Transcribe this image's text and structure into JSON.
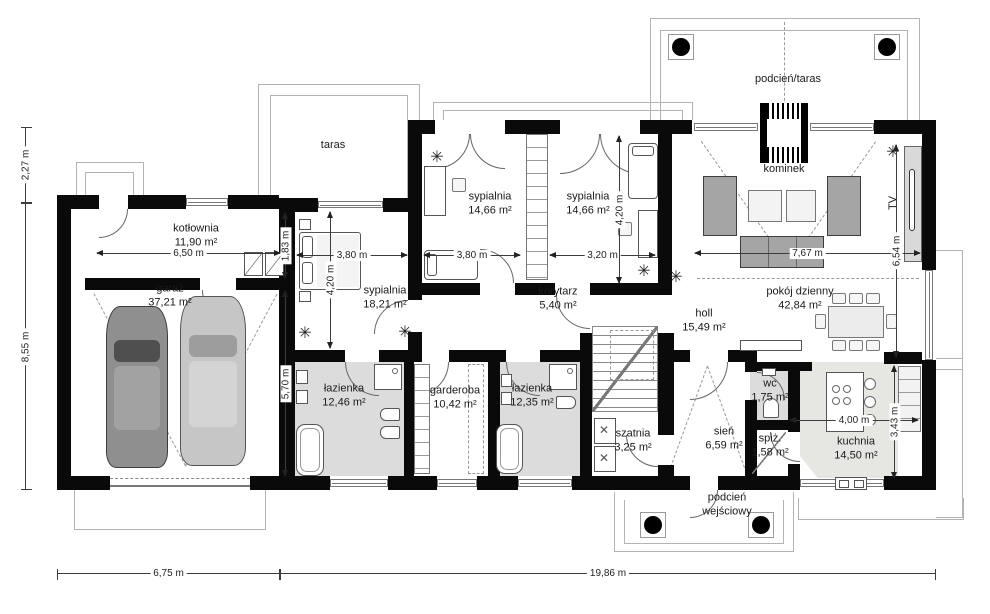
{
  "rooms": {
    "kotlownia": {
      "name": "kotłownia",
      "area": "11,90 m²"
    },
    "garaz": {
      "name": "garaż",
      "area": "37,21 m²"
    },
    "syp1": {
      "name": "sypialnia",
      "area": "18,21 m²"
    },
    "syp2": {
      "name": "sypialnia",
      "area": "14,66 m²"
    },
    "syp3": {
      "name": "sypialnia",
      "area": "14,66 m²"
    },
    "korytarz": {
      "name": "korytarz",
      "area": "5,40 m²"
    },
    "laz1": {
      "name": "łazienka",
      "area": "12,46 m²"
    },
    "garderoba": {
      "name": "garderoba",
      "area": "10,42 m²"
    },
    "laz2": {
      "name": "łazienka",
      "area": "12,35 m²"
    },
    "szatnia": {
      "name": "szatnia",
      "area": "3,25 m²"
    },
    "sien": {
      "name": "sień",
      "area": "6,59 m²"
    },
    "wc": {
      "name": "wc",
      "area": "1,75 m²"
    },
    "spiz": {
      "name": "spiż.",
      "area": "1,58 m²"
    },
    "kuchnia": {
      "name": "kuchnia",
      "area": "14,50 m²"
    },
    "holl": {
      "name": "holl",
      "area": "15,49 m²"
    },
    "pokoj": {
      "name": "pokój dzienny",
      "area": "42,84 m²"
    }
  },
  "labels": {
    "taras": "taras",
    "kominek": "kominek",
    "tv": "TV",
    "podcien_taras": "podcień/taras",
    "podcien_wejsciowy": "podcień wejściowy"
  },
  "dims": {
    "d227": "2,27 m",
    "d855": "8,55 m",
    "d675": "6,75 m",
    "d1986": "19,86 m",
    "d650": "6,50 m",
    "d183": "1,83 m",
    "d570": "5,70 m",
    "d380a": "3,80 m",
    "d420a": "4,20 m",
    "d380b": "3,80 m",
    "d320": "3,20 m",
    "d420b": "4,20 m",
    "d767": "7,67 m",
    "d654": "6,54 m",
    "d400": "4,00 m",
    "d343": "3,43 m"
  }
}
